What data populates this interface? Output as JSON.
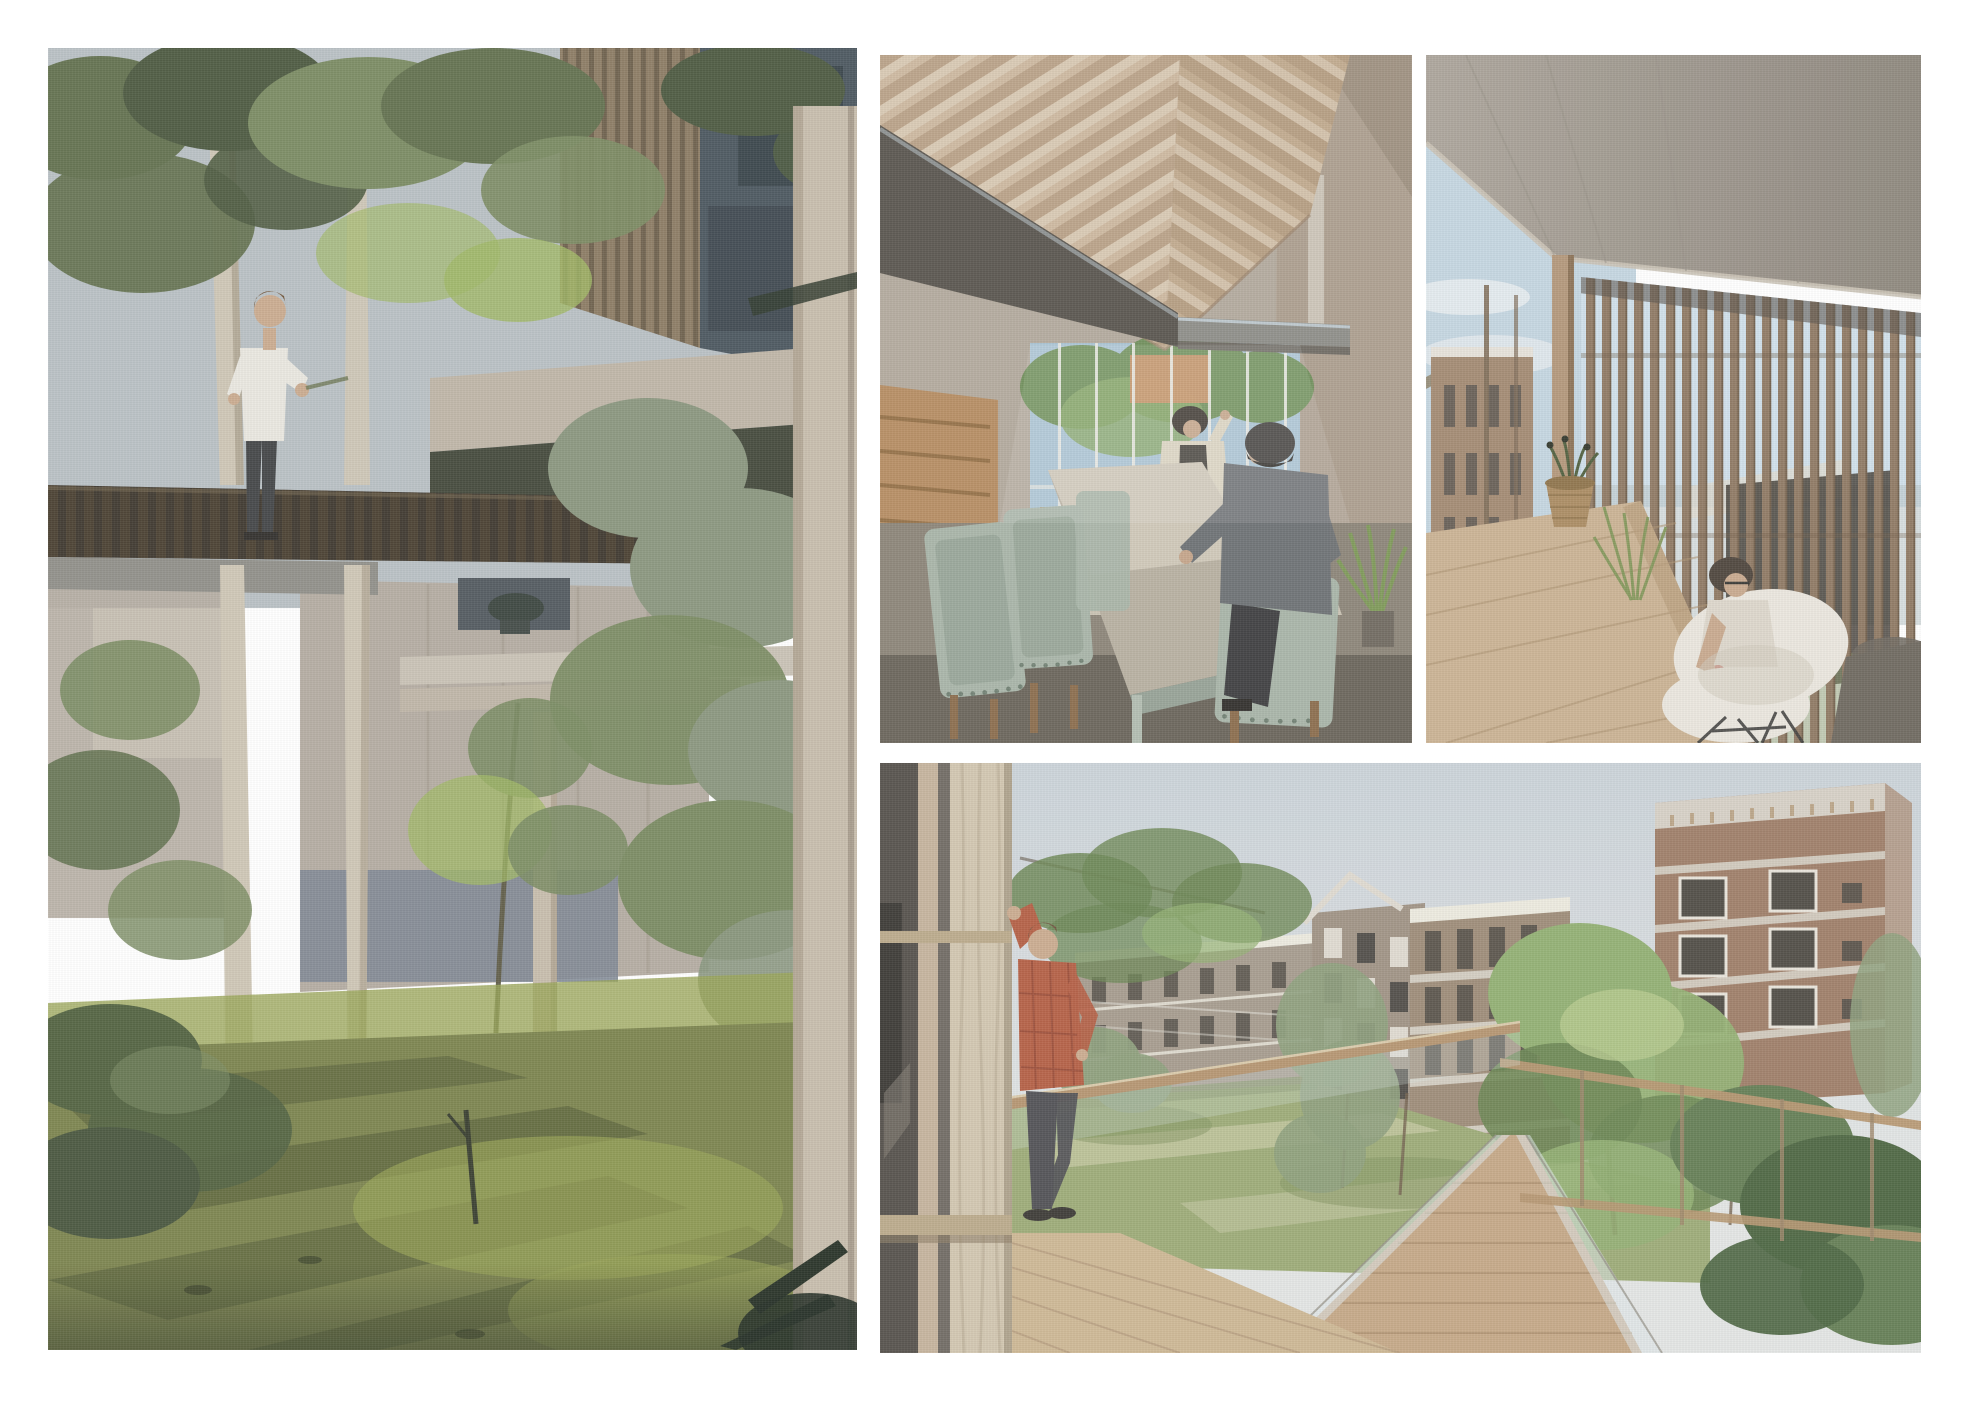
{
  "document": {
    "title": "Architectural visualisation collage",
    "kind": "four-render collage on white sheet"
  },
  "panels": {
    "garden": {
      "label": "Render: garden courtyard with elevated dark timber walkway, man in white t-shirt strolling among birch trees, timber-slat facade behind"
    },
    "dining": {
      "label": "Render: double-height dining hall with exposed gable rafters, long table, sage chairs, two seated people and glazed gable end"
    },
    "terrace": {
      "label": "Render: covered roof terrace with concrete soffit, vertical timber louvres, woven planter and person seated in white shell chair"
    },
    "courtyard": {
      "label": "Render: view from glazed balcony, man in plaid shirt leaning on frame, timber rails and housing blocks in a green courtyard"
    }
  },
  "palette": {
    "page-bg": "#ffffff",
    "g-sky": "#b7bfc3",
    "g-canopy-dark": "#49563c",
    "g-canopy-olive": "#5f6e4b",
    "g-leaf-mid": "#78895f",
    "g-leaf-bright": "#9cb55f",
    "g-leaf-gray": "#87947c",
    "g-slat-wood": "#8a7960",
    "g-slat-gap": "#6b5d49",
    "g-facade-dark": "#47525b",
    "g-facade-panel": "#333d44",
    "g-concrete": "#beb4a5",
    "g-concrete-dark": "#8f887c",
    "g-shadow-void": "#3f4437",
    "g-wall": "#b3aba0",
    "g-wall-lit": "#c8c1b4",
    "g-plinth-blue": "#7c8591",
    "g-walkway": "#3a332a",
    "g-walkway-plank": "#55452f",
    "g-underbeam": "#8e8d86",
    "g-trunk": "#cec5b4",
    "g-trunk-shade": "#a59a86",
    "g-column": "#c6bbaa",
    "g-column-shade": "#ab9f8c",
    "g-grass": "#79814a",
    "g-grass-bright": "#95a150",
    "g-grass-dark": "#4c5630",
    "g-bush": "#4e5f3c",
    "g-frond": "#222d21",
    "g-skin": "#c9a98d",
    "g-hair": "#6f5338",
    "g-shirt": "#e9e7e0",
    "g-pants": "#3e4042",
    "d-bg": "#b3a99c",
    "d-roof-l": "#cdb89f",
    "d-roof-r": "#c0a98d",
    "d-rafter": "#a98e72",
    "d-rafter-light": "#e3d7c4",
    "d-beam-dark": "#57534c",
    "d-beam-top": "#c2ced4",
    "d-slab": "#8d8d87",
    "d-wall-r": "#ac9e8e",
    "d-wall-r-dark": "#958775",
    "d-glass-sky": "#a9c3d3",
    "d-glass-tree": "#6f8f5a",
    "d-glass-tree2": "#88a868",
    "d-facade-orange": "#c79568",
    "d-mullion": "#e9e9e3",
    "d-bench": "#bd9468",
    "d-stair": "#b68c60",
    "d-stair-line": "#8c683f",
    "d-floor": "#8b8377",
    "d-floor-lit": "#d8d1c1",
    "d-floor-dark": "#5a564c",
    "d-table": "#b7afa0",
    "d-table-lit": "#d7d0c0",
    "d-leg-sage": "#b2bcb0",
    "d-chair": "#a7b4a7",
    "d-chair-dark": "#8c9b8d",
    "d-stud": "#6f7f71",
    "d-beanie": "#403e3b",
    "d-sweater": "#6b6f72",
    "d-jacket": "#dbd3c1",
    "d-vest": "#34312c",
    "d-plant": "#7d9a55",
    "d-pot": "#6e685e",
    "d-skin": "#c4a488",
    "d-hairdark": "#3b352e",
    "d-wood-leg": "#8a6b4a",
    "d-under": "#6e6a63",
    "t-ceiling": "#a49d93",
    "t-ceiling-dark": "#8b847a",
    "t-edge": "#c9c1b4",
    "t-shadow": "#554f46",
    "t-sky": "#c3d5e1",
    "t-cloud": "#e9edf0",
    "t-far-brick": "#a1876f",
    "t-far-roof": "#e6e2d9",
    "t-far-win": "#5a554d",
    "t-lawn": "#8ea468",
    "t-post": "#b29578",
    "t-post-dark": "#7c6a55",
    "t-slat": "#8d7660",
    "t-slat-dark": "#6e5b47",
    "t-slat-sky": "#cfe0ea",
    "t-behind-dark": "#3f3a33",
    "t-behind-pale": "#ded8cc",
    "t-behind-green": "#7f8f63",
    "t-counter": "#c9b191",
    "t-counter-line": "#aa8f6d",
    "t-counter-edge": "#b59a78",
    "t-basket": "#a98a5f",
    "t-basket-line": "#8d7148",
    "t-sprig": "#4c5c3a",
    "t-grassplant": "#7f9456",
    "t-chair-white": "#eae6dd",
    "t-chair-shadow": "#cdc7ba",
    "t-skin": "#c7a78c",
    "t-hair": "#4a4038",
    "t-tank": "#dcd6ca",
    "t-pink": "#c27568",
    "t-dark-mass": "#6b655c",
    "t-legs": "#3a3a38",
    "c-sky-top": "#c9d1d8",
    "c-sky-bot": "#e2e5e4",
    "c-glass-dark": "#4f4b45",
    "c-glass-black": "#34322e",
    "c-reflect": "#7b756b",
    "c-mullion": "#c3b199",
    "c-glass2": "#6b665e",
    "c-column": "#d0c4ae",
    "c-column-streak": "#b3a68c",
    "c-column-shade": "#ac9f88",
    "c-transom": "#b9a787",
    "c-transom-sh": "#8a7a60",
    "c-deck": "#ccb591",
    "c-deck-line": "#ab9273",
    "c-shirt": "#b25a3e",
    "c-shirt-dark": "#8a3f2c",
    "c-pants": "#4b4b4f",
    "c-skin": "#c9a88b",
    "c-hair": "#6b4f3a",
    "c-shoe": "#35332f",
    "c-rail": "#b3926c",
    "c-rail-hi": "#d9c9a8",
    "c-glasshint": "#dde6e8",
    "c-postthin": "#9a8265",
    "c-b1": "#a3988a",
    "c-b1-roof": "#eceade",
    "c-b2": "#9c9080",
    "c-b2-white": "#ded9cf",
    "c-b2-dark": "#4b4842",
    "c-b3": "#9a8874",
    "c-b3-band": "#d8d3c8",
    "c-b4": "#9b7a63",
    "c-b4-band": "#d5cfc4",
    "c-b4-face": "#ae9480",
    "c-b4-dash": "#b59b79",
    "c-win-dark": "#4a463f",
    "c-win-frame": "#e8e4da",
    "c-cable": "#d8d5cb",
    "c-lawn": "#99a873",
    "c-lawn-light": "#bfc49b",
    "c-lawn-dark": "#7d8f5c",
    "c-tree-bright": "#8fae6e",
    "c-tree-light": "#b3c788",
    "c-tree-dark": "#66824d",
    "c-tree-gray": "#8a9c78",
    "c-bush-dark": "#5f7a4f",
    "c-bush-deep": "#47613c",
    "c-trunk": "#6e5c48",
    "c-walkdeck": "#c3a583",
    "c-walkline": "#a88a67"
  }
}
